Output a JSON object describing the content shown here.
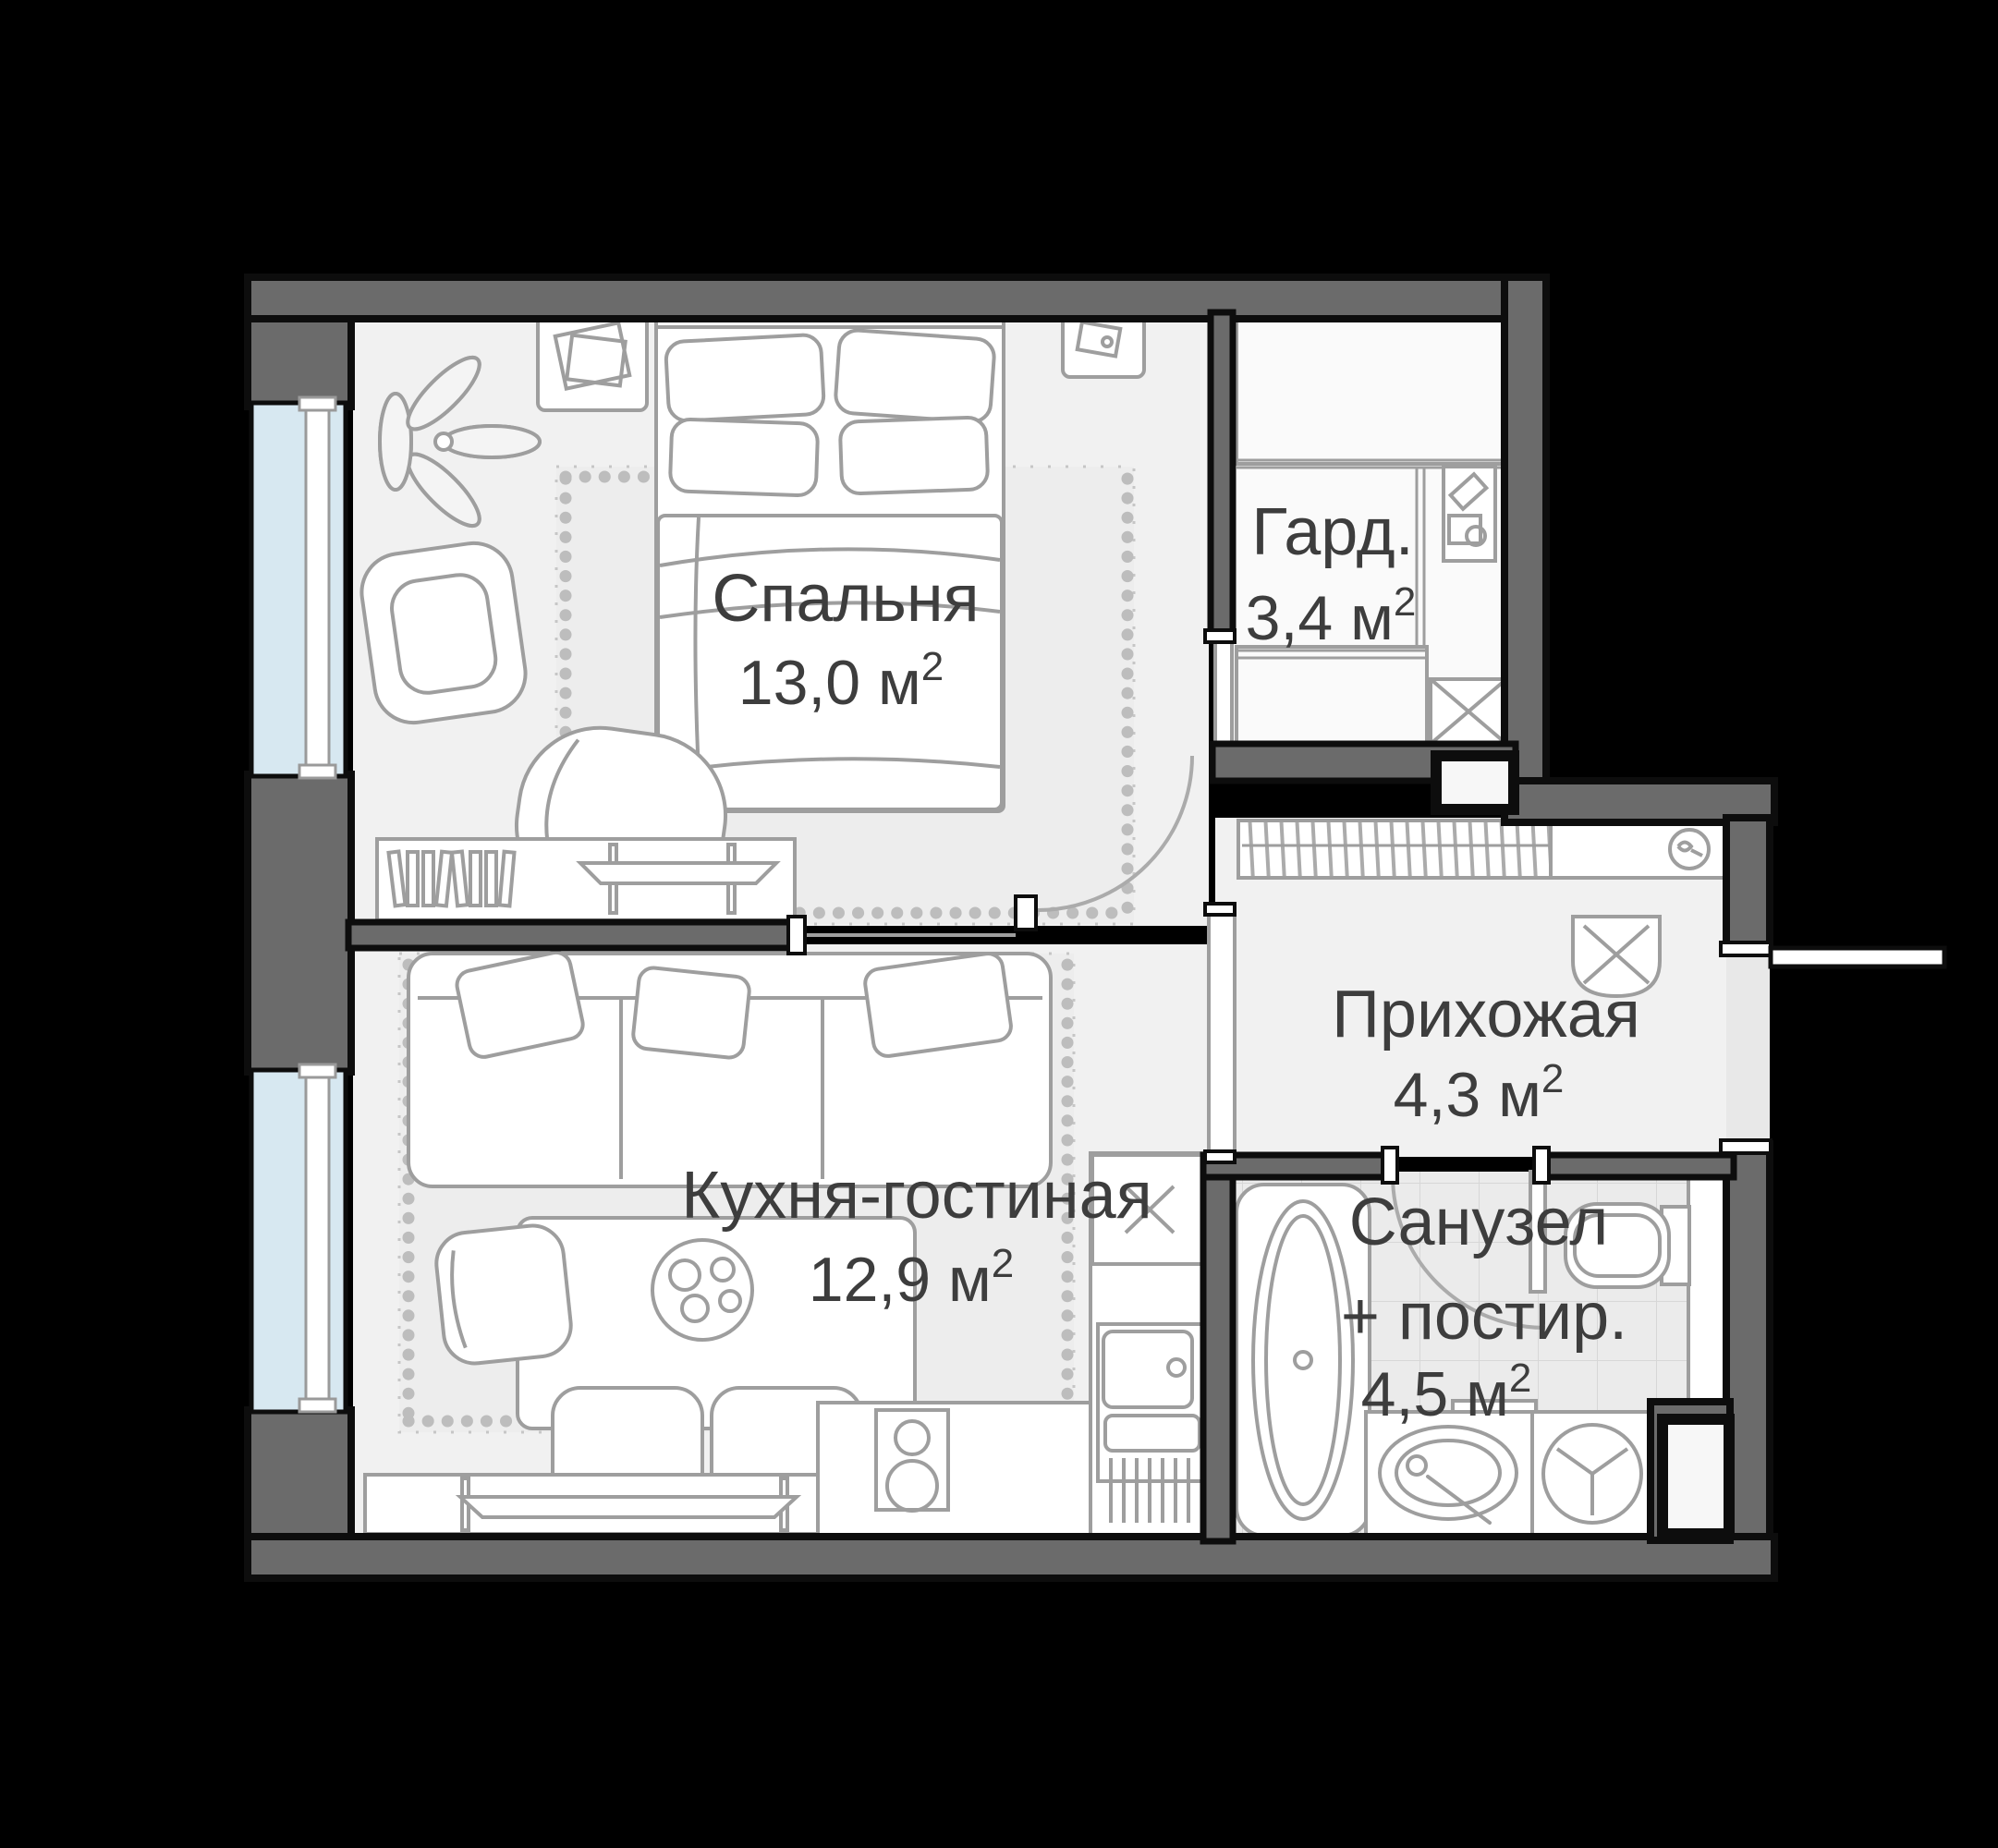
{
  "plan": {
    "rooms": {
      "bedroom": {
        "name": "Спальня",
        "area": "13,0 м",
        "area_sup": "2"
      },
      "wardrobe": {
        "name": "Гард.",
        "area": "3,4 м",
        "area_sup": "2"
      },
      "hallway": {
        "name": "Прихожая",
        "area": "4,3 м",
        "area_sup": "2"
      },
      "kitchen_living": {
        "name": "Кухня-гостиная",
        "area": "12,9 м",
        "area_sup": "2"
      },
      "bathroom": {
        "name_line1": "Санузел",
        "name_line2": "+ постир.",
        "area": "4,5 м",
        "area_sup": "2"
      }
    },
    "colors": {
      "background": "#000000",
      "wall_fill": "#6b6b6b",
      "wall_outline": "#0d0d0d",
      "floor": "#f1f1f1",
      "floor_wardrobe": "#fafafa",
      "floor_tile": "#ebebeb",
      "window_glass": "#d7e8f1",
      "furniture_stroke": "#9e9e9e",
      "label_text": "#3d3d3d"
    }
  }
}
